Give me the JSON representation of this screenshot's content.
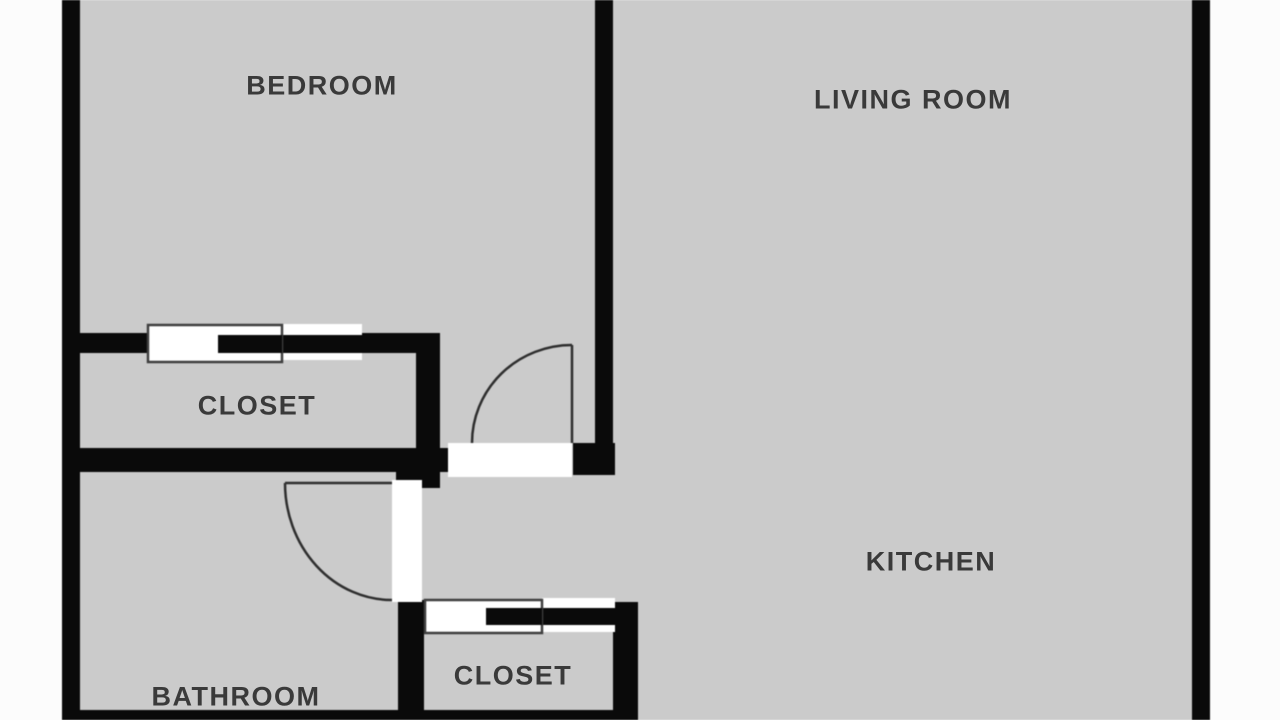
{
  "title": "Apartment floor plan",
  "colors": {
    "page_bg": "#fcfcfc",
    "floor": "#cbcbcb",
    "wall": "#0a0a0a",
    "door_fill": "#ffffff",
    "door_outline": "#3f3f3f",
    "door_swing": "#2e2e2e",
    "label_text": "#3a3a3a"
  },
  "rooms": [
    {
      "label": "BEDROOM"
    },
    {
      "label": "LIVING ROOM"
    },
    {
      "label": "CLOSET"
    },
    {
      "label": "KITCHEN"
    },
    {
      "label": "BATHROOM"
    },
    {
      "label": "CLOSET"
    }
  ]
}
